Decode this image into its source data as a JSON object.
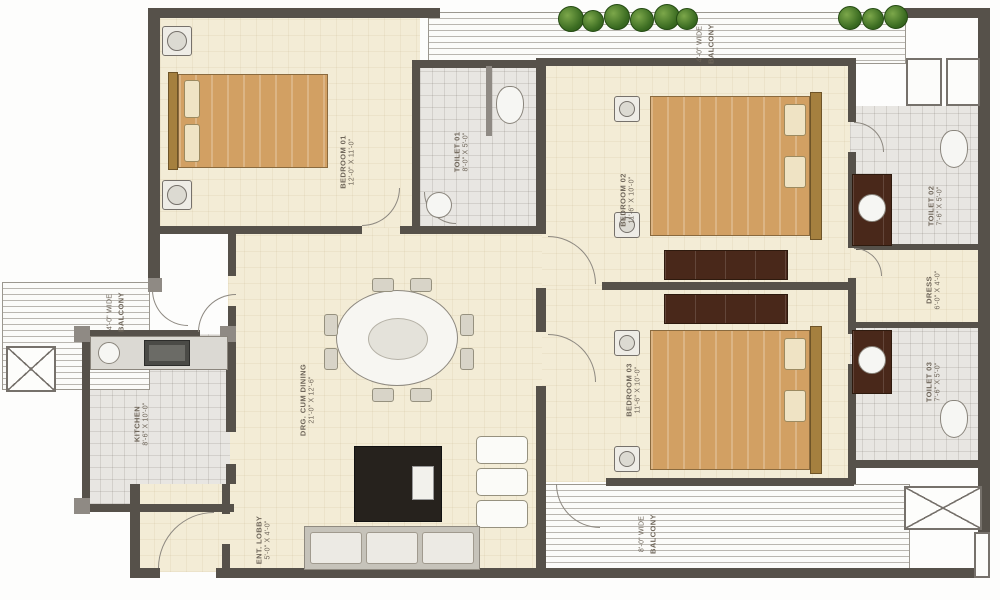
{
  "plan": {
    "type": "residential-apartment-floor-plan",
    "rooms": [
      {
        "id": "bedroom-1",
        "label": "BEDROOM 01",
        "dims": "12'-0\" X 11'-0\""
      },
      {
        "id": "toilet-1",
        "label": "TOILET 01",
        "dims": "8'-0\" X 5'-0\""
      },
      {
        "id": "bedroom-2",
        "label": "BEDROOM 02",
        "dims": "11'-6\" X 10'-0\""
      },
      {
        "id": "toilet-2",
        "label": "TOILET 02",
        "dims": "7'-6\" X 5'-0\""
      },
      {
        "id": "dress",
        "label": "DRESS",
        "dims": "6'-0\" X 4'-0\""
      },
      {
        "id": "bedroom-3",
        "label": "BEDROOM 03",
        "dims": "11'-6\" X 10'-0\""
      },
      {
        "id": "toilet-3",
        "label": "TOILET 03",
        "dims": "7'-6\" X 5'-0\""
      },
      {
        "id": "living-dining",
        "label": "DRG. CUM DINING",
        "dims": "21'-0\" X 12'-6\""
      },
      {
        "id": "kitchen",
        "label": "KITCHEN",
        "dims": "8'-6\" X 10'-0\""
      },
      {
        "id": "entry-lobby",
        "label": "ENT. LOBBY",
        "dims": "5'-0\" X 4'-0\""
      },
      {
        "id": "balcony-top",
        "label": "BALCONY",
        "dims": "4'-0\" WIDE"
      },
      {
        "id": "balcony-left",
        "label": "BALCONY",
        "dims": "4'-0\" WIDE"
      },
      {
        "id": "balcony-bottom",
        "label": "BALCONY",
        "dims": "8'-0\" WIDE"
      }
    ],
    "colors": {
      "wall": "#56514a",
      "floor": "#f3ecd6",
      "tile": "#e8e6e2",
      "hatchline": "#b9b6b0",
      "bed": "#d2a063",
      "wood": "#49281a",
      "plant": "#3f7226",
      "label": "#6f665a"
    }
  }
}
